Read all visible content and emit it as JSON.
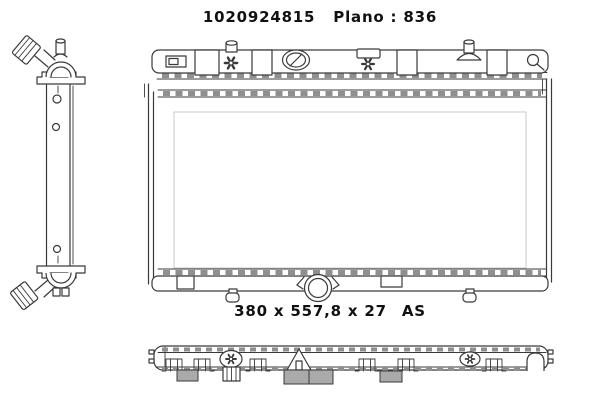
{
  "header": {
    "part_number": "1020924815",
    "plano": "Plano : 836"
  },
  "dimensions": {
    "size": "380 x 557,8 x 27",
    "code": "AS"
  },
  "colors": {
    "line": "#3a3a3a",
    "crimp": "#8f8f8f",
    "shade": "#aaaaaa",
    "text": "#111111",
    "background": "#ffffff"
  }
}
